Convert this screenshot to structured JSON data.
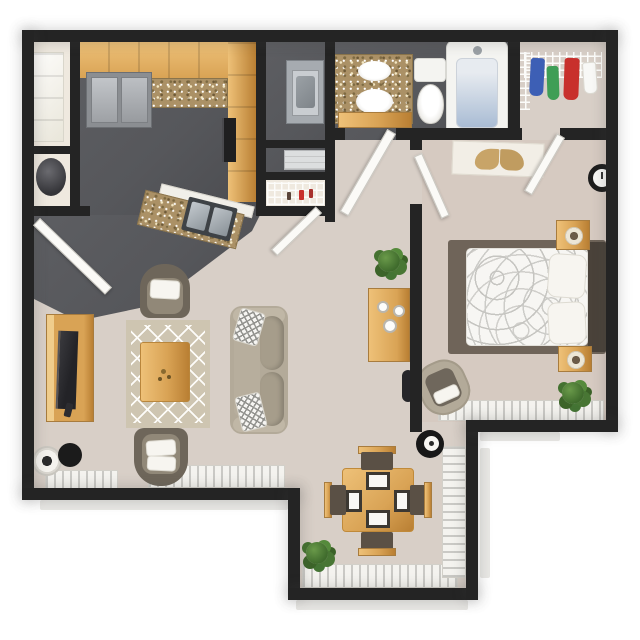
{
  "scene": {
    "title": "3D top-down floor plan of a one-bedroom apartment",
    "render_style": "3D architectural rendering, bird's-eye view",
    "canvas_size": "640x640",
    "background": "#ffffff",
    "text_labels": []
  },
  "palette": {
    "wall": "#242424",
    "carpet": "#d8cfc7",
    "carpetbed": "#d6cac1",
    "charcoal": "#56575b",
    "cream": "#efe9df",
    "wood": "#d9a355",
    "woodhi": "#eec178",
    "woodlo": "#b97f33",
    "granite": "#ab9166",
    "fixture": "#f4f4f1",
    "steel": "#a6abb0",
    "rug": "#cec5b1",
    "sofabody": "#b3aa99",
    "sofacushion": "#a69d8b",
    "chairdark": "#6e665a",
    "chairinner": "#918878",
    "bedrug": "#6f6459",
    "headboard": "#4a423a",
    "mattress": "#f7f6f3",
    "windowband": "#f4f3ef",
    "sill": "#e9e8e5",
    "tubwater": "#a9bcd4",
    "seatbrown": "#5a5045",
    "clothblue": "#3d5fb5",
    "clothgreen": "#3f9e56",
    "clothred": "#c8302c"
  },
  "rooms": [
    {
      "name": "kitchen",
      "floor": "dark vinyl",
      "items": [
        "refrigerator",
        "upper cabinets",
        "granite countertop",
        "range oven",
        "angled peninsula with double stainless sink"
      ]
    },
    {
      "name": "entry",
      "floor": "dark vinyl",
      "items": [
        "front door",
        "linen closet with white shelves",
        "water heater closet"
      ]
    },
    {
      "name": "laundry closet",
      "floor": "dark vinyl",
      "items": [
        "washer",
        "dryer",
        "wire pantry shelving",
        "bifold door"
      ]
    },
    {
      "name": "bathroom",
      "floor": "dark vinyl",
      "items": [
        "granite vanity with oval sink and mirror",
        "toilet",
        "bathtub"
      ]
    },
    {
      "name": "bedroom closet",
      "floor": "carpet",
      "items": [
        "white wire shelf",
        "hanging clothes blue green red white"
      ]
    },
    {
      "name": "bedroom",
      "floor": "carpet",
      "items": [
        "bed with patterned white duvet",
        "dark headboard",
        "two wood nightstands with lamps",
        "wall clock",
        "ceiling fan panel with leaf motif",
        "accent chair",
        "potted plant",
        "window with blinds"
      ]
    },
    {
      "name": "living room",
      "floor": "carpet",
      "items": [
        "tv console with flat tv",
        "area rug with diamond pattern",
        "wood coffee table",
        "sofa with chevron pillows",
        "two barrel chairs with white pillows",
        "floor lamp",
        "round side table",
        "wood sideboard with white decor",
        "plant",
        "windows with blinds"
      ]
    },
    {
      "name": "dining area",
      "floor": "carpet",
      "items": [
        "square wood table",
        "four chairs with dark seats",
        "four white placemats",
        "floor lamp",
        "potted plant",
        "corner windows with blinds"
      ]
    }
  ]
}
